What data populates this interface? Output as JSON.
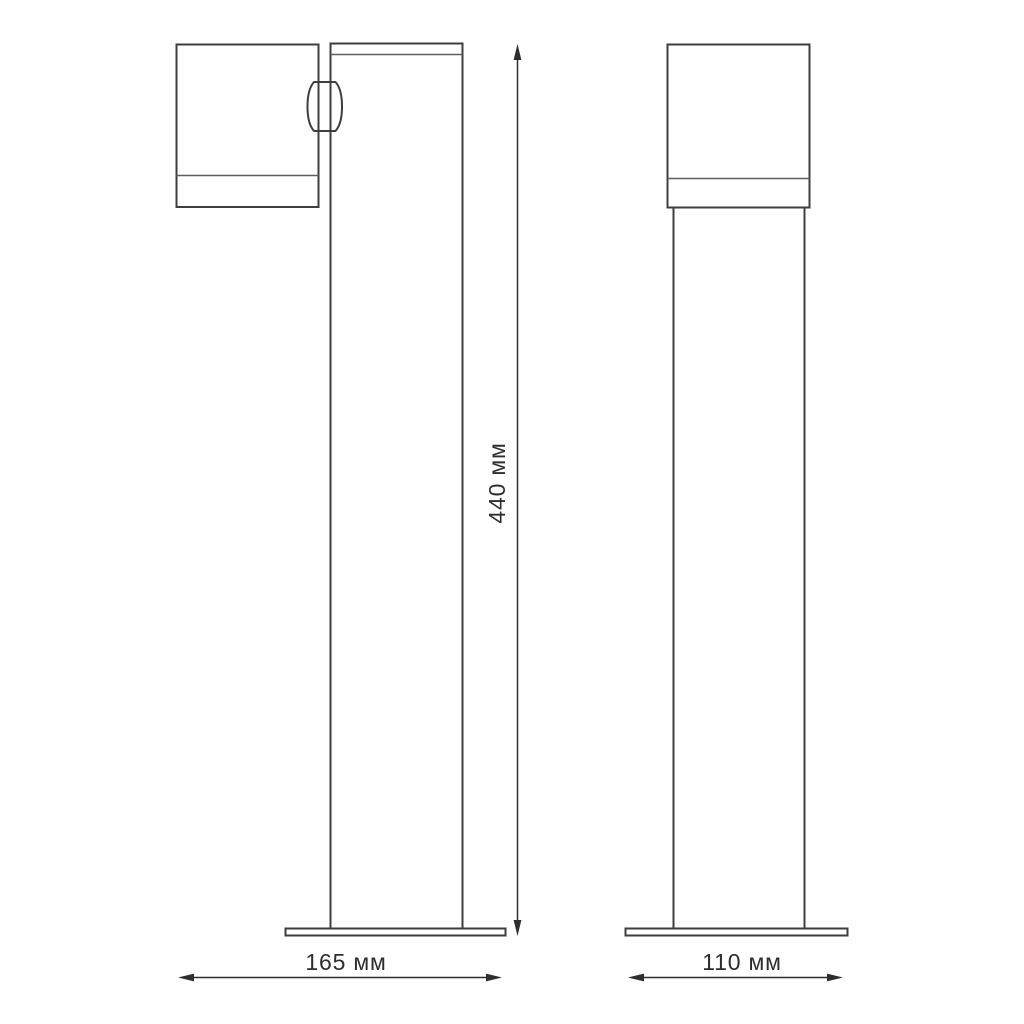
{
  "diagram": {
    "kind": "technical-dimension-drawing",
    "subject": "bollard-light-fixture-two-views",
    "colors": {
      "background": "#fefefe",
      "outline": "#3e3e3e",
      "seam_line": "#5e5e5e",
      "dimension_line": "#2e2e2e",
      "label_text": "#2e2e2e"
    },
    "dimensions": {
      "height": {
        "label": "440 мм",
        "value": 440,
        "unit": "мм"
      },
      "depth": {
        "label": "165 мм",
        "value": 165,
        "unit": "мм"
      },
      "width": {
        "label": "110 мм",
        "value": 110,
        "unit": "мм"
      }
    }
  }
}
